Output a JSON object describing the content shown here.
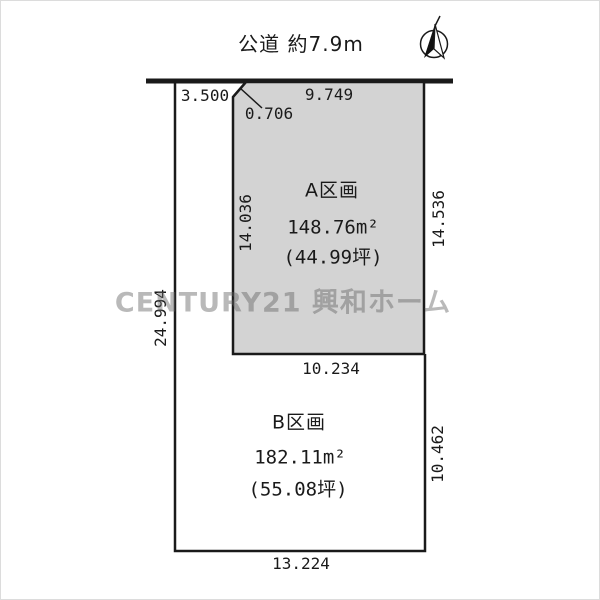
{
  "road": {
    "label": "公道 約7.9m"
  },
  "plot_a": {
    "name": "A区画",
    "area_m2": "148.76m²",
    "area_tsubo": "(44.99坪)"
  },
  "plot_b": {
    "name": "B区画",
    "area_m2": "182.11m²",
    "area_tsubo": "(55.08坪)"
  },
  "dims": {
    "frontage_b_strip": "3.500",
    "a_top": "9.749",
    "chamfer": "0.706",
    "a_left": "14.036",
    "a_right": "14.536",
    "left_total": "24.994",
    "a_bottom": "10.234",
    "b_right": "10.462",
    "b_bottom": "13.224"
  },
  "watermark": {
    "text": "CENTURY21 興和ホーム"
  },
  "colors": {
    "plot_a_fill": "#d3d3d3",
    "line": "#1a1a1a",
    "watermark_gray": "#9a9a9a"
  }
}
